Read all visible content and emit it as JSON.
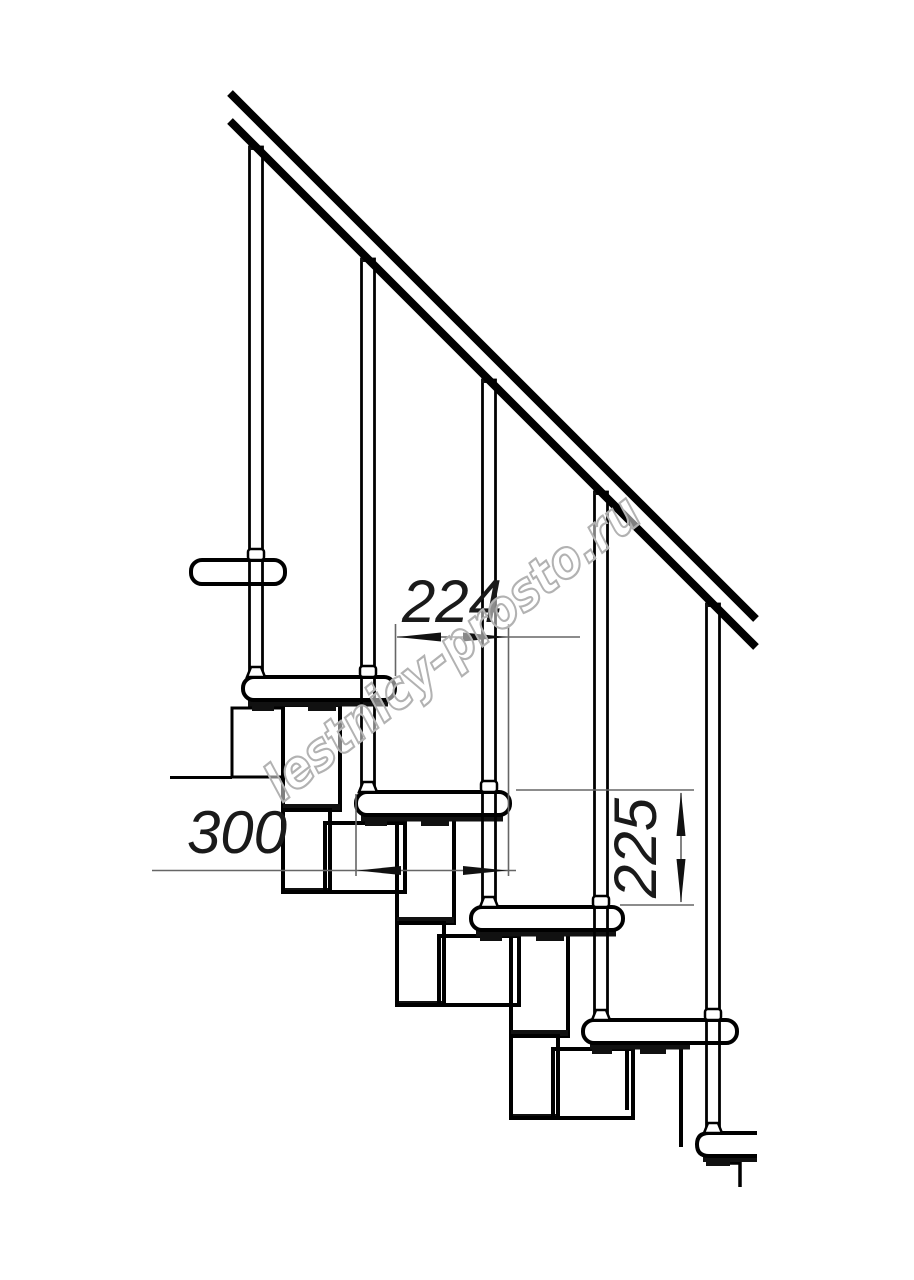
{
  "drawing": {
    "description": "Side-view technical drawing of a modular staircase with handrail, balusters, treads and module chain",
    "background_color": "#ffffff",
    "line_color": "#000000",
    "dimension_line_color": "#666666",
    "annotations": {
      "dim_horizontal_top": "224",
      "dim_horizontal_left": "300",
      "dim_vertical_right": "225"
    },
    "watermark": {
      "text": "lestnicy-prosto.ru",
      "color": "#b2b2b2"
    }
  }
}
